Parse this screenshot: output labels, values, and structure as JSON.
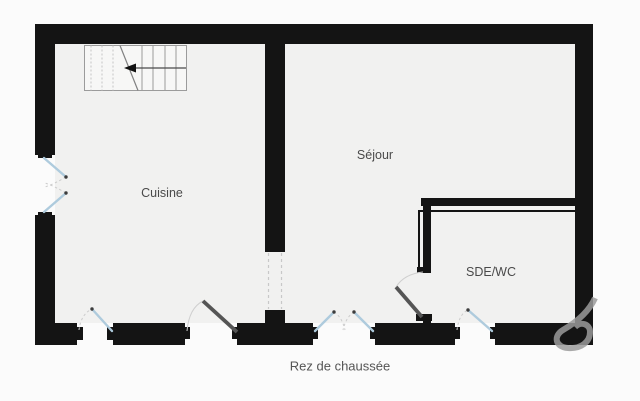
{
  "plan": {
    "caption": "Rez de chaussée",
    "rooms": [
      {
        "id": "cuisine",
        "name": "Cuisine"
      },
      {
        "id": "sejour",
        "name": "Séjour"
      },
      {
        "id": "sde_wc",
        "name": "SDE/WC"
      }
    ]
  },
  "colors": {
    "background": "#fbfbfb",
    "floor": "#f1f1f0",
    "wall": "#141414",
    "window": "#aecbdd",
    "door": "#555555",
    "arc": "#cccccc",
    "stair": "#9b9b9b",
    "label_text": "#4a4a4a",
    "watermark": "#9a9a9a"
  }
}
